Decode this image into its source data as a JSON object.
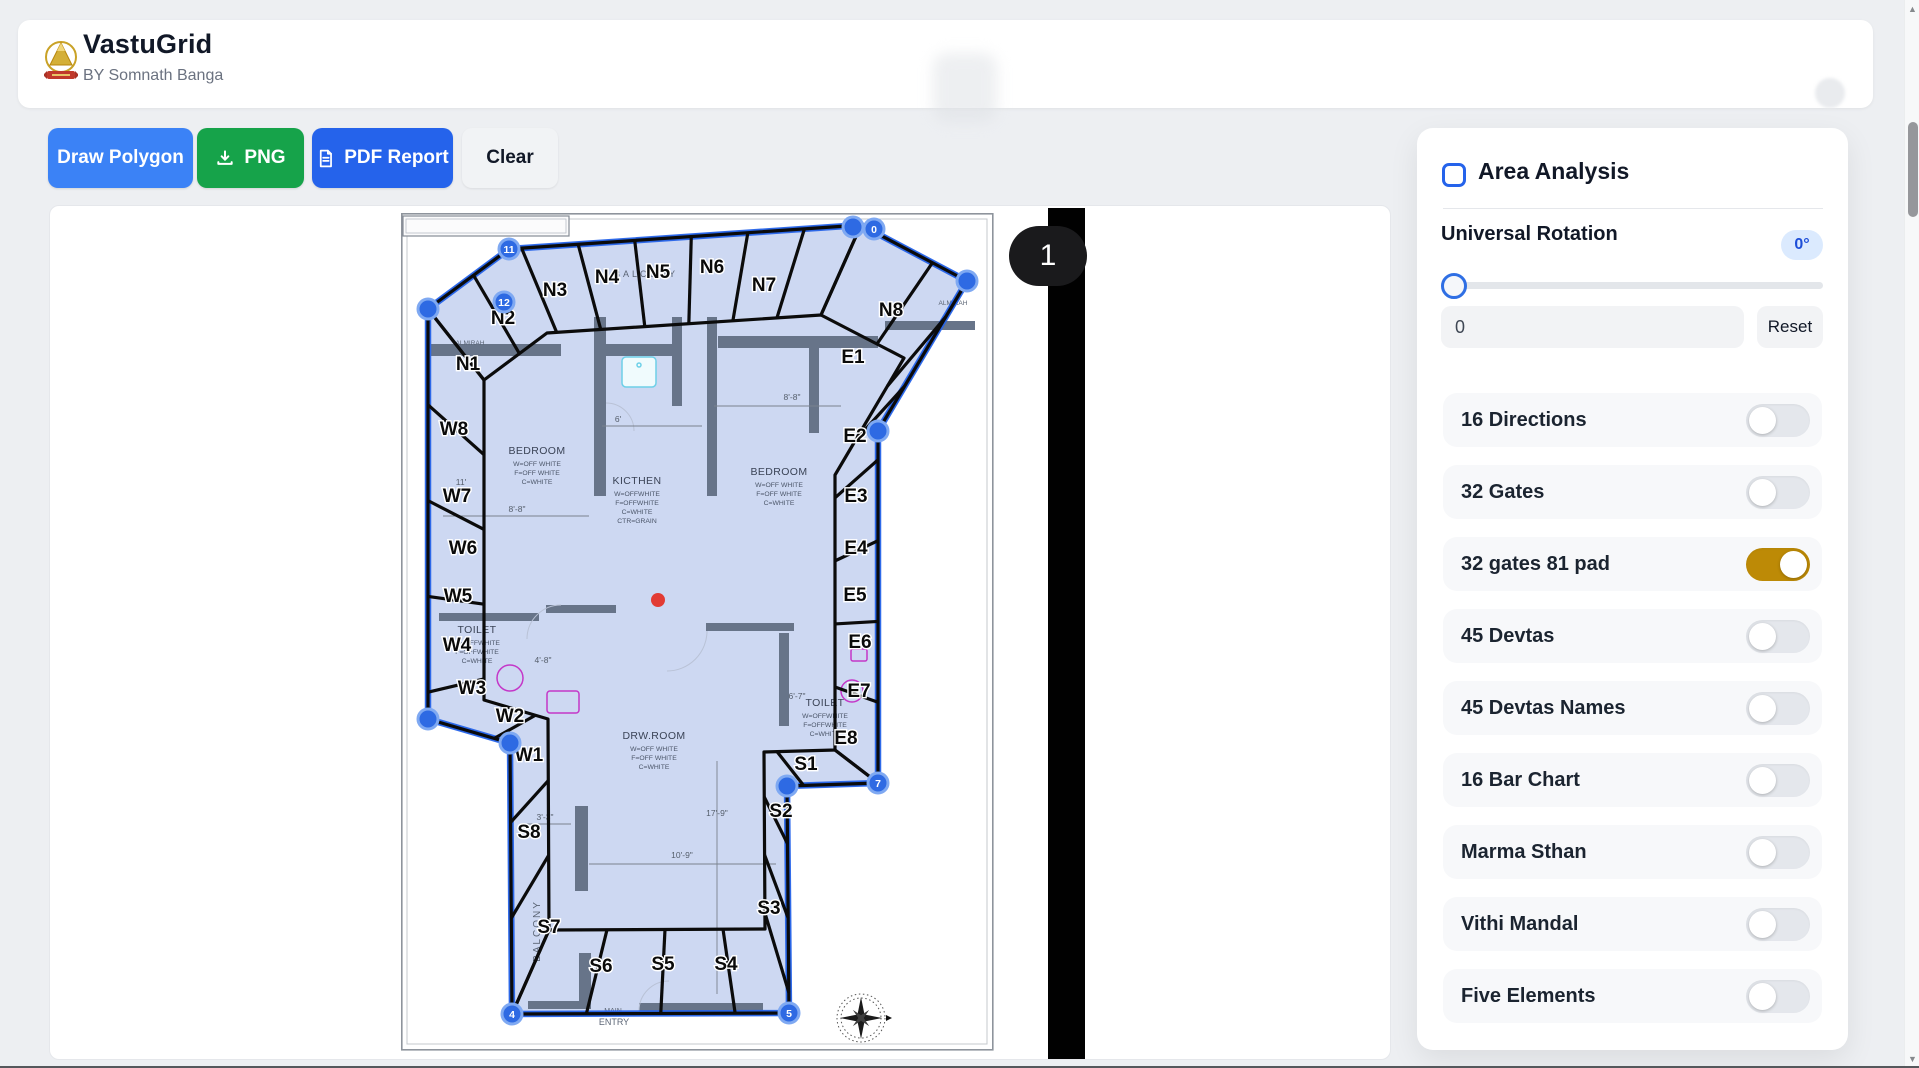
{
  "header": {
    "app_title": "VastuGrid",
    "subtitle": "BY Somnath Banga",
    "logo_icon": "kalash-emblem-icon"
  },
  "toolbar": {
    "draw_polygon_label": "Draw Polygon",
    "png_label": "PNG",
    "png_icon": "download-icon",
    "pdf_label": "PDF Report",
    "pdf_icon": "document-icon",
    "clear_label": "Clear"
  },
  "canvas": {
    "page_badge": "1"
  },
  "panel": {
    "title": "Area Analysis",
    "rotation": {
      "label": "Universal Rotation",
      "badge": "0°",
      "input_value": "0",
      "reset_label": "Reset"
    },
    "toggles": [
      {
        "label": "16 Directions",
        "on": false
      },
      {
        "label": "32 Gates",
        "on": false
      },
      {
        "label": "32 gates 81 pad",
        "on": true
      },
      {
        "label": "45 Devtas",
        "on": false
      },
      {
        "label": "45 Devtas Names",
        "on": false
      },
      {
        "label": "16 Bar Chart",
        "on": false
      },
      {
        "label": "Marma Sthan",
        "on": false
      },
      {
        "label": "Vithi Mandal",
        "on": false
      },
      {
        "label": "Five Elements",
        "on": false
      }
    ]
  },
  "colors": {
    "accent_on": "#bd8a06",
    "primary_blue": "#3b82f6",
    "pdf_blue": "#2563eb",
    "png_green": "#16a34a",
    "outline_blue": "#2563eb",
    "handle_blue": "#2e6ae3",
    "center_dot": "#e23b34",
    "badge_bg": "#dbeafe",
    "badge_text": "#1d4ed8"
  },
  "plan": {
    "outline": [
      [
        108,
        36
      ],
      [
        460,
        12
      ],
      [
        566,
        68
      ],
      [
        477,
        218
      ],
      [
        477,
        570
      ],
      [
        386,
        573
      ],
      [
        388,
        800
      ],
      [
        111,
        801
      ],
      [
        109,
        530
      ],
      [
        27,
        506
      ],
      [
        27,
        96
      ]
    ],
    "inner": [
      [
        146,
        120
      ],
      [
        420,
        102
      ],
      [
        503,
        145
      ],
      [
        434,
        262
      ],
      [
        434,
        537
      ],
      [
        363,
        539
      ],
      [
        364,
        716
      ],
      [
        148,
        717
      ],
      [
        147,
        506
      ],
      [
        83,
        487
      ],
      [
        83,
        167
      ]
    ],
    "ring": [
      {
        "outer": [
          [
            27,
            96
          ],
          [
            108,
            36
          ],
          [
            460,
            12
          ]
        ],
        "inner": [
          [
            83,
            167
          ],
          [
            146,
            120
          ],
          [
            420,
            102
          ]
        ]
      },
      {
        "outer": [
          [
            460,
            12
          ],
          [
            566,
            68
          ],
          [
            477,
            218
          ],
          [
            477,
            570
          ]
        ],
        "inner": [
          [
            420,
            102
          ],
          [
            503,
            145
          ],
          [
            434,
            262
          ],
          [
            434,
            537
          ]
        ]
      },
      {
        "outer": [
          [
            477,
            570
          ],
          [
            386,
            573
          ],
          [
            388,
            800
          ],
          [
            111,
            801
          ]
        ],
        "inner": [
          [
            434,
            537
          ],
          [
            363,
            539
          ],
          [
            364,
            716
          ],
          [
            148,
            717
          ]
        ]
      },
      {
        "outer": [
          [
            111,
            801
          ],
          [
            109,
            530
          ],
          [
            27,
            506
          ],
          [
            27,
            96
          ]
        ],
        "inner": [
          [
            148,
            717
          ],
          [
            147,
            506
          ],
          [
            83,
            487
          ],
          [
            83,
            167
          ]
        ]
      }
    ],
    "walls": [
      [
        193,
        104,
        12,
        179
      ],
      [
        271,
        104,
        10,
        89
      ],
      [
        306,
        104,
        10,
        179
      ],
      [
        30,
        131,
        130,
        12
      ],
      [
        205,
        131,
        66,
        12
      ],
      [
        317,
        123,
        160,
        12
      ],
      [
        408,
        125,
        10,
        95
      ],
      [
        484,
        108,
        90,
        9
      ],
      [
        145,
        392,
        70,
        8
      ],
      [
        305,
        410,
        88,
        8
      ],
      [
        38,
        400,
        100,
        8
      ],
      [
        174,
        593,
        13,
        85
      ],
      [
        178,
        740,
        12,
        56
      ],
      [
        238,
        790,
        124,
        8
      ],
      [
        127,
        788,
        58,
        8
      ],
      [
        378,
        420,
        10,
        93
      ]
    ],
    "sectors": [
      [
        "N1",
        67,
        157
      ],
      [
        "N2",
        102,
        111
      ],
      [
        "N3",
        154,
        83
      ],
      [
        "N4",
        206,
        70
      ],
      [
        "N5",
        257,
        65
      ],
      [
        "N6",
        311,
        60
      ],
      [
        "N7",
        363,
        78
      ],
      [
        "N8",
        490,
        103
      ],
      [
        "E1",
        452,
        150
      ],
      [
        "E2",
        454,
        229
      ],
      [
        "E3",
        455,
        289
      ],
      [
        "E4",
        455,
        341
      ],
      [
        "E5",
        454,
        388
      ],
      [
        "E6",
        459,
        435
      ],
      [
        "E7",
        458,
        484
      ],
      [
        "E8",
        445,
        531
      ],
      [
        "S1",
        405,
        557
      ],
      [
        "S2",
        380,
        604
      ],
      [
        "S3",
        368,
        701
      ],
      [
        "S4",
        325,
        757
      ],
      [
        "S5",
        262,
        757
      ],
      [
        "S6",
        200,
        759
      ],
      [
        "S7",
        148,
        720
      ],
      [
        "S8",
        128,
        625
      ],
      [
        "W1",
        128,
        548
      ],
      [
        "W2",
        109,
        509
      ],
      [
        "W3",
        71,
        481
      ],
      [
        "W4",
        56,
        438
      ],
      [
        "W5",
        57,
        389
      ],
      [
        "W6",
        62,
        341
      ],
      [
        "W7",
        56,
        289
      ],
      [
        "W8",
        53,
        222
      ]
    ],
    "vertices": [
      [
        108,
        36,
        "11"
      ],
      [
        103,
        89,
        "12"
      ],
      [
        452,
        14,
        ""
      ],
      [
        473,
        16,
        "0"
      ],
      [
        566,
        68,
        ""
      ],
      [
        477,
        218,
        ""
      ],
      [
        477,
        570,
        "7"
      ],
      [
        386,
        573,
        ""
      ],
      [
        388,
        800,
        "5"
      ],
      [
        111,
        801,
        "4"
      ],
      [
        109,
        530,
        ""
      ],
      [
        27,
        506,
        ""
      ],
      [
        27,
        96,
        ""
      ]
    ],
    "rooms": [
      {
        "x": 136,
        "y": 241,
        "lines": [
          "BEDROOM",
          "W=OFF WHITE",
          "F=OFF WHITE",
          "C=WHITE"
        ]
      },
      {
        "x": 236,
        "y": 271,
        "lines": [
          "KICTHEN",
          "W=OFFWHITE",
          "F=OFFWHITE",
          "C=WHITE",
          "CTR=GRAIN"
        ]
      },
      {
        "x": 378,
        "y": 262,
        "lines": [
          "BEDROOM",
          "W=OFF WHITE",
          "F=OFF WHITE",
          "C=WHITE"
        ]
      },
      {
        "x": 76,
        "y": 420,
        "lines": [
          "TOILET",
          "W=OFFWHITE",
          "F=OFFWHITE",
          "C=WHITE"
        ]
      },
      {
        "x": 424,
        "y": 493,
        "lines": [
          "TOILET",
          "W=OFFWHITE",
          "F=OFFWHITE",
          "C=WHITE"
        ]
      },
      {
        "x": 253,
        "y": 526,
        "lines": [
          "DRW.ROOM",
          "W=OFF WHITE",
          "F=OFF WHITE",
          "C=WHITE"
        ]
      }
    ],
    "dims": [
      [
        "8'-8\"",
        391,
        187
      ],
      [
        "6'",
        217,
        209
      ],
      [
        "8'-8\"",
        116,
        299
      ],
      [
        "4'-8\"",
        142,
        450
      ],
      [
        "6'-7\"",
        396,
        486
      ],
      [
        "3'-3\"",
        144,
        607
      ],
      [
        "17'-9\"",
        316,
        603
      ],
      [
        "10'-9\"",
        281,
        645
      ],
      [
        "11'",
        60,
        272
      ]
    ],
    "dim_lines": "M313,193H440 M201,213H301 M42,303H188 M120,611H170 M188,651H375 M316,548V781",
    "texts": {
      "balcony_top": "BALCONY",
      "balcony_side": "BALCONY",
      "almirah_left": "ALMIRAH",
      "almirah_right": "ALMIRAH",
      "main": "MAIN",
      "entry": "ENTRY"
    }
  }
}
